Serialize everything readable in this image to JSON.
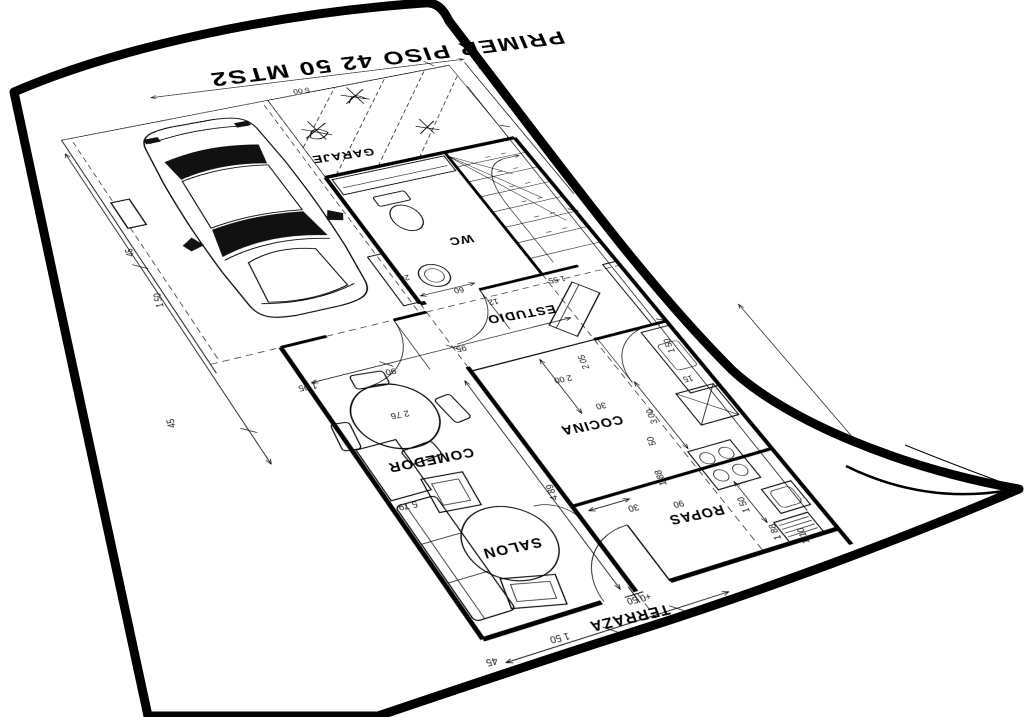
{
  "sheet": {
    "title": "PRIMER PISO 42 50 MTS2"
  },
  "plan": {
    "rooms": [
      {
        "name": "GARAJE",
        "x": 270,
        "y": 123
      },
      {
        "name": "WC",
        "x": 348,
        "y": 243
      },
      {
        "name": "ESTUDIO",
        "x": 376,
        "y": 336
      },
      {
        "name": "COCINA",
        "x": 399,
        "y": 463
      },
      {
        "name": "COMEDOR",
        "x": 258,
        "y": 467
      },
      {
        "name": "SALON",
        "x": 298,
        "y": 563
      },
      {
        "name": "ROPAS",
        "x": 455,
        "y": 568
      },
      {
        "name": "TERRAZA",
        "x": 369,
        "y": 646
      }
    ],
    "dimensions": [
      {
        "t": "5 00",
        "x": 252,
        "y": 36,
        "r": 0
      },
      {
        "t": "1 50",
        "x": 80,
        "y": 262,
        "r": 90
      },
      {
        "t": "45",
        "x": 66,
        "y": 205,
        "r": 90
      },
      {
        "t": "45",
        "x": 66,
        "y": 390,
        "r": 90
      },
      {
        "t": "1 05",
        "x": 178,
        "y": 375,
        "r": 0
      },
      {
        "t": "90",
        "x": 249,
        "y": 374,
        "r": 0
      },
      {
        "t": "95",
        "x": 314,
        "y": 363,
        "r": 0
      },
      {
        "t": "12",
        "x": 356,
        "y": 319,
        "r": 0
      },
      {
        "t": "1 55",
        "x": 419,
        "y": 306,
        "r": 0
      },
      {
        "t": "26",
        "x": 287,
        "y": 277,
        "r": 0
      },
      {
        "t": "60",
        "x": 330,
        "y": 300,
        "r": 0
      },
      {
        "t": "2 05",
        "x": 416,
        "y": 402,
        "r": 90
      },
      {
        "t": "2 00",
        "x": 390,
        "y": 413,
        "r": 0
      },
      {
        "t": "30",
        "x": 413,
        "y": 447,
        "r": 0
      },
      {
        "t": "50",
        "x": 446,
        "y": 494,
        "r": 90
      },
      {
        "t": "3 00",
        "x": 455,
        "y": 470,
        "r": 90
      },
      {
        "t": "15",
        "x": 497,
        "y": 436,
        "r": 0
      },
      {
        "t": "4 89",
        "x": 348,
        "y": 524,
        "r": 90
      },
      {
        "t": "1 88",
        "x": 441,
        "y": 531,
        "r": 90
      },
      {
        "t": "90",
        "x": 444,
        "y": 556,
        "r": 0
      },
      {
        "t": "30",
        "x": 406,
        "y": 551,
        "r": 0
      },
      {
        "t": "1 50",
        "x": 500,
        "y": 572,
        "r": 90
      },
      {
        "t": "1 88",
        "x": 516,
        "y": 603,
        "r": 90
      },
      {
        "t": "1 10",
        "x": 538,
        "y": 612,
        "r": 90
      },
      {
        "t": "1 50",
        "x": 496,
        "y": 401,
        "r": 90
      },
      {
        "t": "2 76",
        "x": 245,
        "y": 419,
        "r": 0
      },
      {
        "t": "5 79",
        "x": 228,
        "y": 507,
        "r": 0
      },
      {
        "t": "1 50",
        "x": 310,
        "y": 651,
        "r": 0
      },
      {
        "t": "45",
        "x": 253,
        "y": 658,
        "r": 0
      },
      {
        "t": "+0 50",
        "x": 382,
        "y": 633,
        "r": 0
      }
    ],
    "stair_steps": 8
  },
  "icons": {
    "car": "car-top-view-icon",
    "toilet": "toilet-icon",
    "washbasin": "washbasin-icon",
    "stove": "stove-icon",
    "fridge": "fridge-icon",
    "washer": "washing-machine-icon",
    "dining_table": "dining-table-icon",
    "sofa": "sofa-icon",
    "stairs": "staircase-icon",
    "plant": "plant-icon",
    "door": "door-swing-icon",
    "level_mark": "level-mark-icon"
  },
  "colors": {
    "ink": "#000000",
    "paper": "#ffffff",
    "background": "#ffffff",
    "glass": "#111111"
  }
}
